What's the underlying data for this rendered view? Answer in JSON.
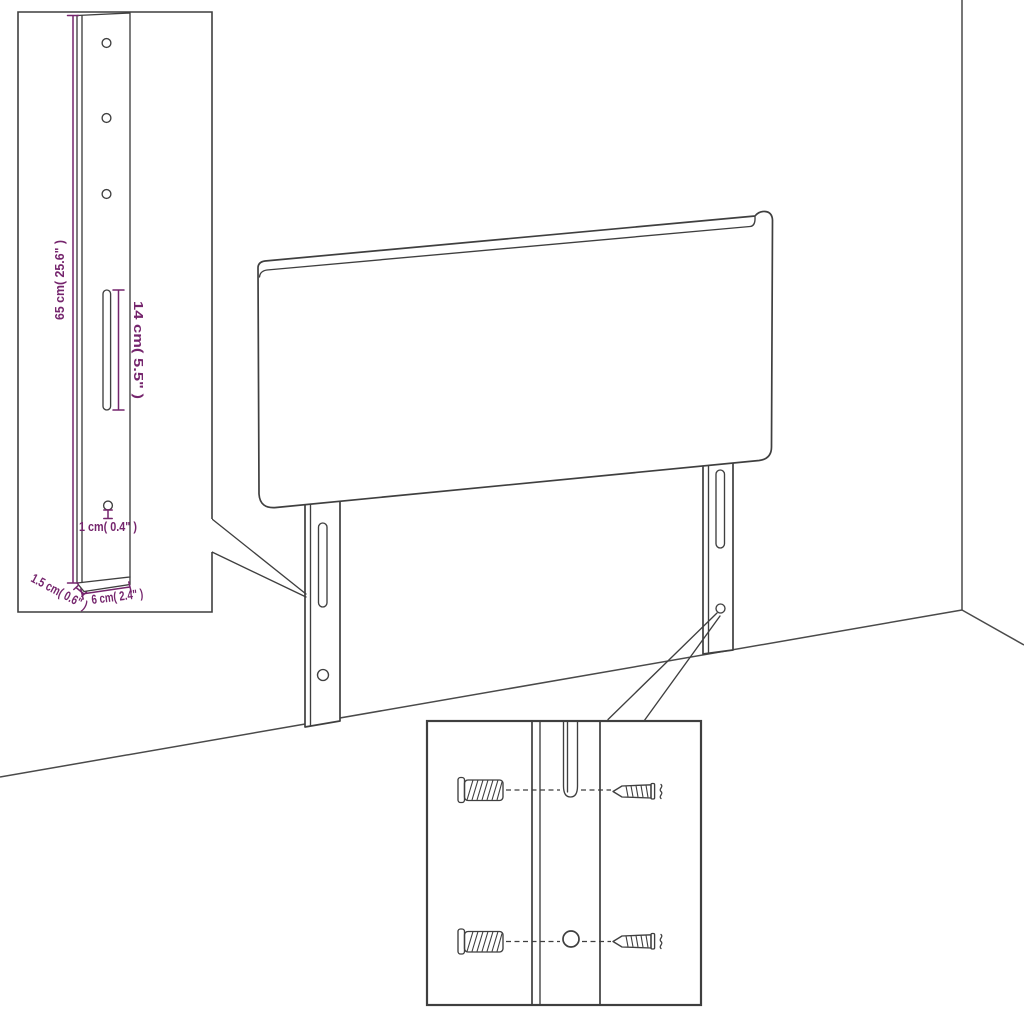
{
  "colors": {
    "background": "#ffffff",
    "line": "#3f3f3f",
    "room_line": "#4a4a4a",
    "dimension": "#75256d"
  },
  "labels": {
    "bracket_height": "65 cm( 25.6\" )",
    "slot_length": "14 cm( 5.5\" )",
    "hole_diameter": "1 cm( 0.4\" )",
    "bracket_thickness": "1.5 cm( 0.6\" )",
    "bracket_width": "6 cm( 2.4\" )"
  },
  "parts": {
    "main": "headboard-with-mounting-legs",
    "inset_top_left": "leg-bracket-dimension-detail",
    "inset_bottom": "wall-anchor-and-screw-mounting-detail",
    "hardware": [
      "wall-anchor",
      "screw"
    ]
  }
}
